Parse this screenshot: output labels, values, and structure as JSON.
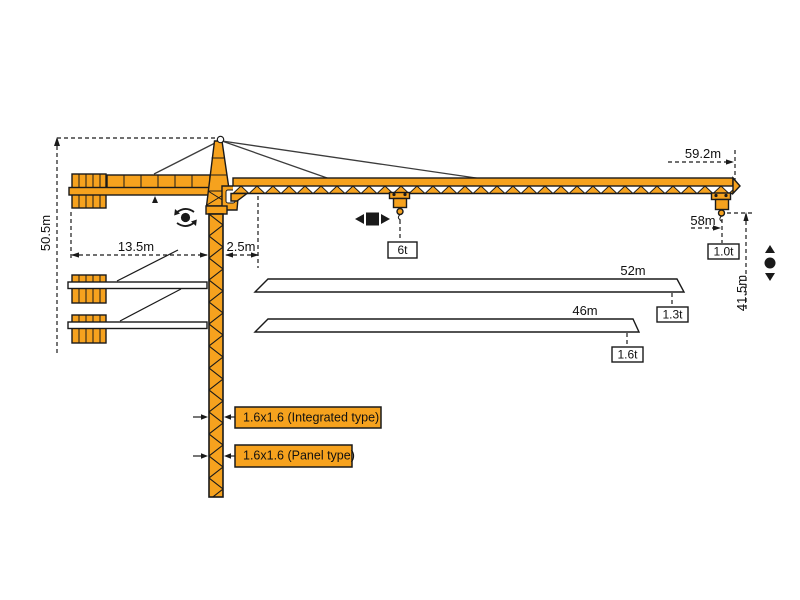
{
  "colors": {
    "crane": "#F6A21E",
    "line": "#1A1A1A",
    "background": "#FFFFFF"
  },
  "dimensions": {
    "total_height": "50.5m",
    "counterjib_radius": "13.5m",
    "slew_offset": "2.5m",
    "max_radius": "59.2m",
    "tip_hook_radius": "58m",
    "hook_travel": "41.5m"
  },
  "loads": {
    "mid_jib": "6t",
    "jib_59_tip": "1.0t",
    "jib_52_tip": "1.3t",
    "jib_46_tip": "1.6t"
  },
  "jib_options": {
    "jib_52": "52m",
    "jib_46": "46m"
  },
  "mast_sections": {
    "integrated": "1.6x1.6 (Integrated type)",
    "panel": "1.6x1.6 (Panel type)"
  },
  "icons": {
    "slewing": "slewing-rotation-icon",
    "trolley": "trolley-travel-icon",
    "hoist": "hook-hoist-icon"
  }
}
